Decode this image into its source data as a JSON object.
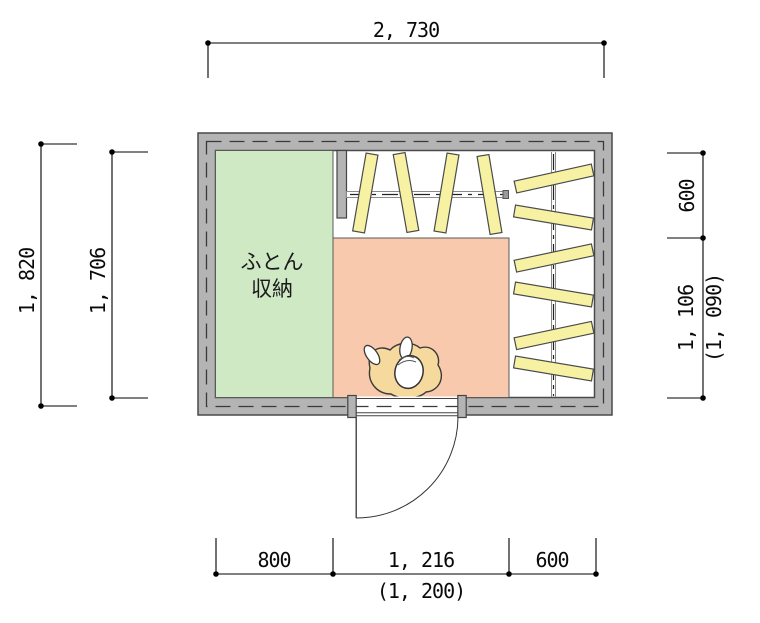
{
  "drawing": {
    "room_label": {
      "line1": "ふとん",
      "line2": "収納"
    },
    "dimensions": {
      "top_width": "2, 730",
      "left_outer_height": "1, 820",
      "left_inner_height": "1, 706",
      "right_upper": "600",
      "right_lower": "1, 106",
      "right_lower_alt": "(1, 090)",
      "bottom_left": "800",
      "bottom_center": "1, 216",
      "bottom_right": "600",
      "bottom_center_alt": "(1, 200)"
    },
    "colors": {
      "wall": "#b4b4b4",
      "futon_area": "#cfe9c5",
      "floor_mat": "#f8c9ac",
      "hanger_bar": "#f7f2a3",
      "person_body": "#f5d99d"
    }
  }
}
